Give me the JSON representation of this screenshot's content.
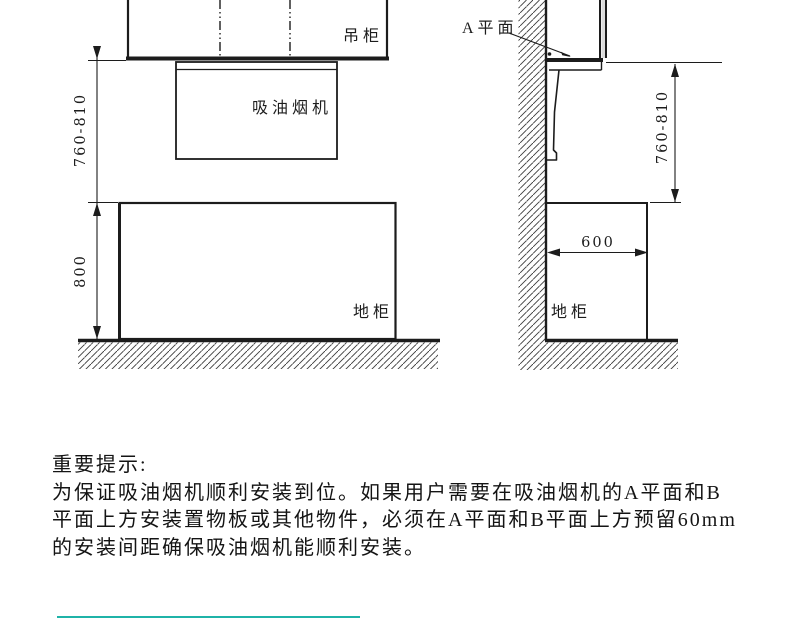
{
  "diagram": {
    "front_view": {
      "hanging_cabinet_label": "吊柜",
      "range_hood_label": "吸油烟机",
      "base_cabinet_label": "地柜",
      "hood_height_dim": "760-810",
      "counter_height_dim": "800"
    },
    "side_view": {
      "a_plane_label": "A平面",
      "hood_height_dim": "760-810",
      "cabinet_depth_dim": "600",
      "base_cabinet_label": "地柜"
    }
  },
  "note": {
    "title": "重要提示:",
    "lines": [
      "为保证吸油烟机顺利安装到位。如果用户需要在吸油烟机的A平面和B",
      "平面上方安装置物板或其他物件，必须在A平面和B平面上方预留60mm",
      "的安装间距确保吸油烟机能顺利安装。"
    ]
  },
  "colors": {
    "line_color": "#1c1c1c",
    "footer_accent": "#1fb3a8"
  }
}
